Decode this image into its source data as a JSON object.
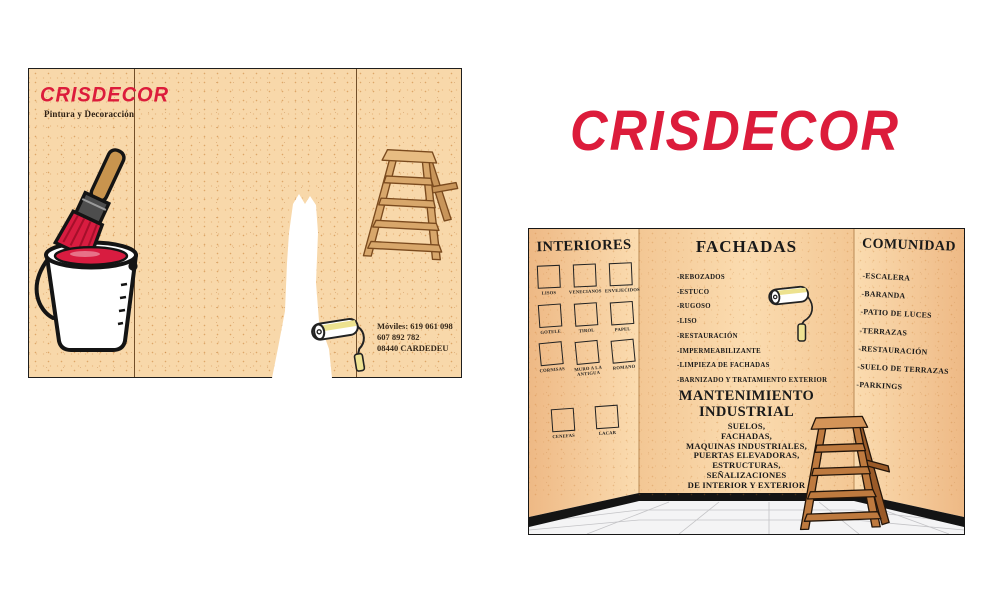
{
  "brand": {
    "name": "CRISDECOR",
    "tagline": "Pintura y Decoracción",
    "logo_color": "#DC1C3B",
    "paper_color": "#F8D8AA"
  },
  "cover": {
    "contact": {
      "line1": "Móviles: 619 061 098",
      "line2": "607 892 782",
      "line3": "08440 CARDEDEU"
    },
    "icons": [
      "paint-bucket-with-brush",
      "white-paint-stripe-with-roller",
      "wooden-step-ladder"
    ]
  },
  "logo_large": "CRISDECOR",
  "interior": {
    "interiores": {
      "title": "INTERIORES",
      "swatches": [
        "LISOS",
        "VENECIANOS",
        "ENVEJECIDOS",
        "GOTELE",
        "TIROL",
        "PAPEL",
        "CORNISAS",
        "MURO A LA ANTIGUA",
        "ROMANO"
      ],
      "swatches_bottom": [
        "CENEFAS",
        "LACAR"
      ]
    },
    "fachadas": {
      "title": "FACHADAS",
      "items": [
        "-REBOZADOS",
        "-ESTUCO",
        "-RUGOSO",
        "-LISO",
        "-RESTAURACIÓN",
        "-IMPERMEABILIZANTE",
        "-LIMPIEZA DE FACHADAS",
        "-BARNIZADO Y TRATAMIENTO EXTERIOR"
      ]
    },
    "mantenimiento": {
      "title_line1": "MANTENIMIENTO",
      "title_line2": "INDUSTRIAL",
      "items": [
        "SUELOS,",
        "FACHADAS,",
        "MAQUINAS INDUSTRIALES,",
        "PUERTAS ELEVADORAS,",
        "ESTRUCTURAS,",
        "SEÑALIZACIONES",
        "DE INTERIOR Y EXTERIOR"
      ]
    },
    "comunidad": {
      "title": "COMUNIDAD",
      "items": [
        "-ESCALERA",
        "-BARANDA",
        "-PATIO DE LUCES",
        "-TERRAZAS",
        "-RESTAURACIÓN",
        "-SUELO DE TERRAZAS",
        "-PARKINGS"
      ]
    }
  }
}
